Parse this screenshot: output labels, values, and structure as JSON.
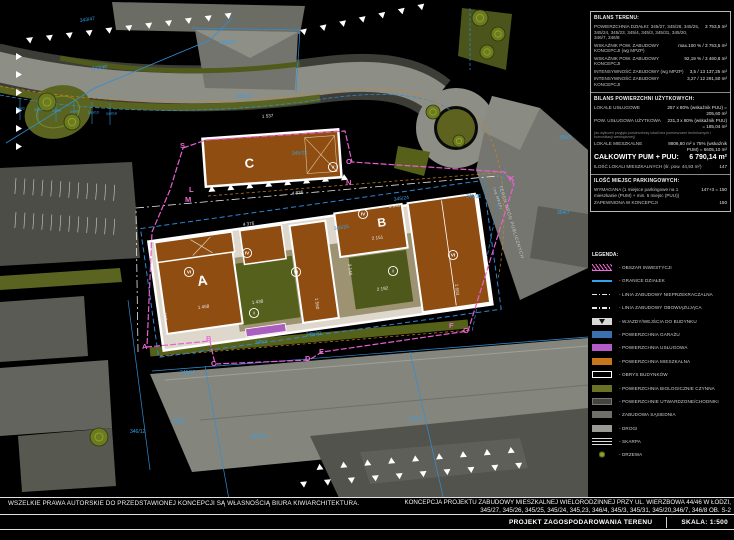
{
  "panel": {
    "bilans_terenu": {
      "title": "BILANS TERENU:",
      "rows": [
        {
          "label": "POWIERZCHNIA DZIAŁKI: 345/27, 345/26, 345/25, 345/24, 345/23, 345/4, 345/3, 345/31, 345/20, 346/7, 346/8",
          "value": "3 753,5 m²"
        },
        {
          "label": "WSKAŹNIK POW. ZABUDOWY KONCEPCJI (wg MPZP)",
          "value": "max.100 % / 3 753,5 m²"
        },
        {
          "label": "WSKAŹNIK POW. ZABUDOWY KONCEPCJI",
          "value": "92,19 % / 3 460,8 m²"
        },
        {
          "label": "INTENSYWNOŚĆ ZABUDOWY (wg MPZP)",
          "value": "3,5 / 13 137,25 m²"
        },
        {
          "label": "INTENSYWNOŚĆ ZABUDOWY KONCEPCJI",
          "value": "3,27 / 12 291,50 m²"
        }
      ]
    },
    "bilans_puu": {
      "title": "BILANS POWIERZCHNI UŻYTKOWYCH:",
      "rows": [
        {
          "label": "LOKALE USŁUGOWE",
          "value": "257 x 80% (wskaźnik PUU) = 205,60 m²"
        },
        {
          "label": "POW. USŁUGOWA UŻYTKOWA",
          "value": "231,3 x 80% (wskaźnik PUU) = 185,04 m²"
        },
        {
          "label": "LOKALE MIESZKALNE",
          "value": "8806,80 m² x 75% (wskaźnik PUM) = 6605,10 m²"
        }
      ],
      "note": "(do wyliczeń przyjęto powierzchnię lokali bez pomieszczeń technicznych i komunikacji wewnętrznej)",
      "total_label": "CAŁKOWITY PUM + PUU:",
      "total_value": "6 790,14 m²",
      "units_label": "ILOŚĆ LOKALI MIESZKALNYCH (śr. pow. 44,93 m²)",
      "units_value": "147"
    },
    "parking": {
      "title": "ILOŚĆ MIEJSC PARKINGOWYCH:",
      "rows": [
        {
          "label": "WYMAGANA (1 miejsce parkingowe na 1 mieszkanie (PUM) + min. 5 miejsc (PUU))",
          "value": "147+3 = 150"
        },
        {
          "label": "ZAPEWNIONA W KONCEPCJI",
          "value": "150"
        }
      ]
    },
    "legend": {
      "title": "LEGENDA:",
      "items": [
        {
          "label": "- OBSZAR INWESTYCJI"
        },
        {
          "label": "- GRANICE DZIAŁEK"
        },
        {
          "label": "- LINIA ZABUDOWY NIEPRZEKRACZALNA"
        },
        {
          "label": "- LINIA ZABUDOWY OBOWIĄZUJĄCA"
        },
        {
          "label": "- WJAZDY/WEJŚCIA DO BUDYNKU"
        },
        {
          "label": "- POWIERZCHNIA GARAŻU"
        },
        {
          "label": "- POWIERZCHNIA USŁUGOWA"
        },
        {
          "label": "- POWIERZCHNIA MIESZKALNA"
        },
        {
          "label": "- OBRYS BUDYNKÓW"
        },
        {
          "label": "- POWIERZCHNIA BIOLOGICZNIE CZYNNA"
        },
        {
          "label": "- POWIERZCHNIE UTWARDZONE/CHODNIKI"
        },
        {
          "label": "- ZABUDOWA SĄSIEDNIA"
        },
        {
          "label": "- DROGI"
        },
        {
          "label": "- SKARPA"
        },
        {
          "label": "- DRZEWA"
        }
      ]
    }
  },
  "plan": {
    "buildings": {
      "a": "A",
      "b": "B",
      "c": "C"
    },
    "storeys": [
      "V",
      "VI",
      "IV",
      "VI",
      "IV",
      "VI",
      "I",
      "I"
    ],
    "parcels": [
      "343/47",
      "343/48",
      "343/22",
      "345/19",
      "345/23",
      "345/26",
      "345/24",
      "345/31",
      "345/20",
      "346/4",
      "346/18",
      "346/17",
      "346/12",
      "346/19",
      "346/9",
      "354/7",
      "354/5",
      "344/2",
      "344/4",
      "344/6",
      "344/8",
      "344/10",
      "344/16"
    ],
    "dimensions": [
      "1 537",
      "4 836",
      "4 376",
      "3 959",
      "2 151",
      "2 192",
      "1 683",
      "1 560",
      "1 458",
      "1 438",
      "908",
      "2 140"
    ],
    "boundary_letters": [
      "A",
      "B",
      "C",
      "D",
      "E",
      "F",
      "G",
      "K",
      "L",
      "M",
      "N",
      "O",
      "S"
    ],
    "road_label_line1": "TEREN DRÓG PUBLICZNYCH",
    "road_label_line2": "(wg MPZP)"
  },
  "colors": {
    "investment_boundary": "#e85fd0",
    "parcel_line": "#36a0e8",
    "residential": "#c8761c",
    "service": "#b45bc7",
    "garage": "#3a6fb0",
    "bio_active": "#6b7223",
    "roads": "#8d8e86",
    "neighbors": "#6a6b64"
  },
  "footer": {
    "copyright": "WSZELKIE PRAWA AUTORSKIE DO PRZEDSTAWIONEJ KONCEPCJI SĄ WŁASNOŚCIĄ BIURA KIWIARCHITEKTURA.",
    "project_line1": "KONCEPCJA PROJEKTU ZABUDOWY MIESZKALNEJ WIELORODZINNEJ PRZY UL. WIERZBOWA 44/46 W ŁODZI,",
    "project_line2": "345/27, 345/26, 345/25, 345/24, 345,23, 346/4, 345/3, 345/31, 345/20,346/7, 346/8 OB. S-2",
    "drawing_title": "PROJEKT ZAGOSPODAROWANIA TERENU",
    "scale": "SKALA: 1:500"
  }
}
